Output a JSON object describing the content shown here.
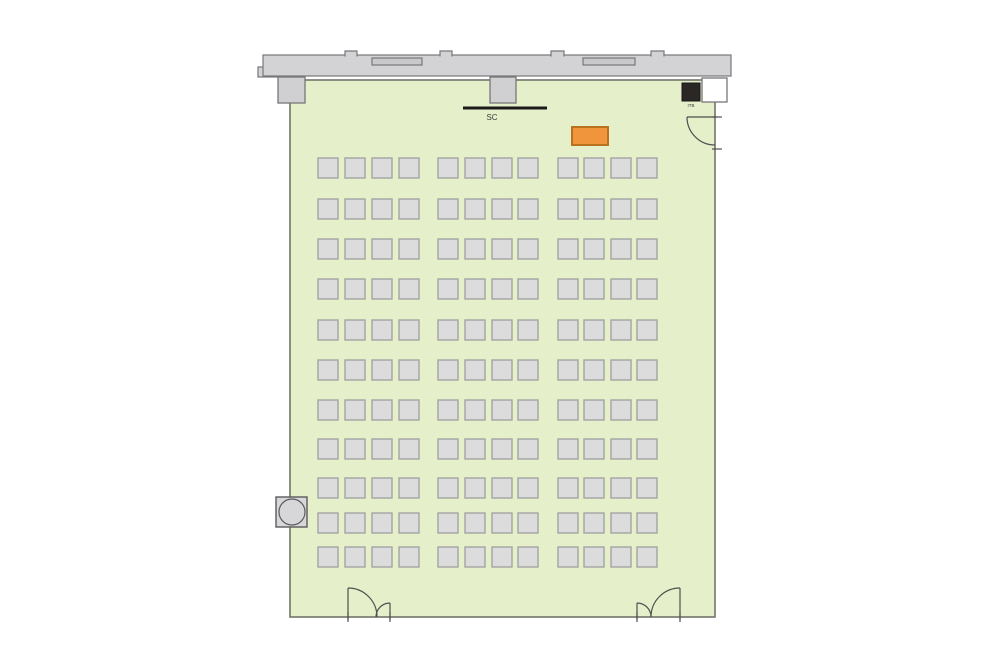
{
  "page": {
    "background": "#ffffff"
  },
  "floorplan": {
    "type": "classroom-seating-plan",
    "canvas": {
      "width": 1000,
      "height": 670
    },
    "colors": {
      "corridor_fill": "#d3d3d5",
      "corridor_stroke": "#77777a",
      "window_fill": "#c9c9cc",
      "window_stroke": "#77777a",
      "room_fill": "#e5efc9",
      "room_stroke": "#70756a",
      "seat_fill": "#dcdcdc",
      "seat_stroke": "#a4a4a4",
      "pillar_fill": "#d0d0d2",
      "pillar_stroke": "#77777a",
      "white_pillar_fill": "#ffffff",
      "equipment_fill": "#2b2724",
      "equipment_stroke": "#1a1a1a",
      "screen_color": "#1a1a1a",
      "desk_fill": "#f0953c",
      "desk_stroke": "#b97320",
      "door_color": "#4f4f4f",
      "fixture_fill": "#d7d7d9",
      "fixture_stroke": "#5a5a5c",
      "label_color": "#3a3a3a"
    },
    "labels": {
      "screen": "SC",
      "equipment": "ITB"
    },
    "corridor": {
      "band": {
        "x": 263,
        "y": 55,
        "w": 468,
        "h": 21
      },
      "left_step": {
        "x": 258,
        "y": 67,
        "w": 24,
        "h": 10
      },
      "tabs": [
        {
          "x": 345,
          "w": 12
        },
        {
          "x": 440,
          "w": 12
        },
        {
          "x": 551,
          "w": 13
        },
        {
          "x": 651,
          "w": 13
        }
      ],
      "windows": [
        {
          "x": 372,
          "y": 58,
          "w": 50,
          "h": 7
        },
        {
          "x": 583,
          "y": 58,
          "w": 52,
          "h": 7
        }
      ]
    },
    "room": {
      "x": 290,
      "y": 80,
      "w": 425,
      "h": 537
    },
    "pillars": [
      {
        "x": 278,
        "y": 77,
        "w": 27,
        "h": 26
      },
      {
        "x": 490,
        "y": 77,
        "w": 26,
        "h": 26
      }
    ],
    "white_pillar": {
      "x": 702,
      "y": 78,
      "w": 25,
      "h": 24
    },
    "equipment_box": {
      "x": 682,
      "y": 83,
      "w": 18,
      "h": 18
    },
    "equipment_label_pos": {
      "x": 691,
      "y": 107
    },
    "screen": {
      "x1": 463,
      "x2": 547,
      "y": 108,
      "thickness": 3,
      "label_x": 492,
      "label_y": 120
    },
    "desk": {
      "x": 572,
      "y": 127,
      "w": 36,
      "h": 18
    },
    "fixture": {
      "x": 276,
      "y": 497,
      "w": 31,
      "h": 30,
      "cx": 292,
      "cy": 512,
      "r": 13
    },
    "seats": {
      "cols": [
        318,
        345,
        372,
        399,
        438,
        465,
        492,
        518,
        558,
        584,
        611,
        637
      ],
      "rows": [
        158,
        199,
        239,
        279,
        320,
        360,
        400,
        439,
        478,
        513,
        547
      ],
      "w": 20,
      "h": 20,
      "rows_count": 11,
      "seats_per_row": 12,
      "total_seats": 132
    },
    "doors": {
      "segments": [
        [
          687,
          117,
          717,
          117
        ],
        [
          712,
          117,
          722,
          117
        ],
        [
          712,
          149,
          722,
          149
        ],
        [
          348,
          588,
          348,
          620
        ],
        [
          390,
          603,
          390,
          620
        ],
        [
          348,
          612,
          348,
          622
        ],
        [
          390,
          612,
          390,
          622
        ],
        [
          637,
          603,
          637,
          620
        ],
        [
          680,
          588,
          680,
          620
        ],
        [
          637,
          612,
          637,
          622
        ],
        [
          680,
          612,
          680,
          622
        ]
      ],
      "arcs": [
        "M687,117 A28,28 0 0 0 715,145",
        "M348,588 A29,29 0 0 1 377,617",
        "M390,603 A14,14 0 0 0 376,617",
        "M637,603 A14,14 0 0 1 651,617",
        "M680,588 A29,29 0 0 0 651,617"
      ]
    }
  }
}
